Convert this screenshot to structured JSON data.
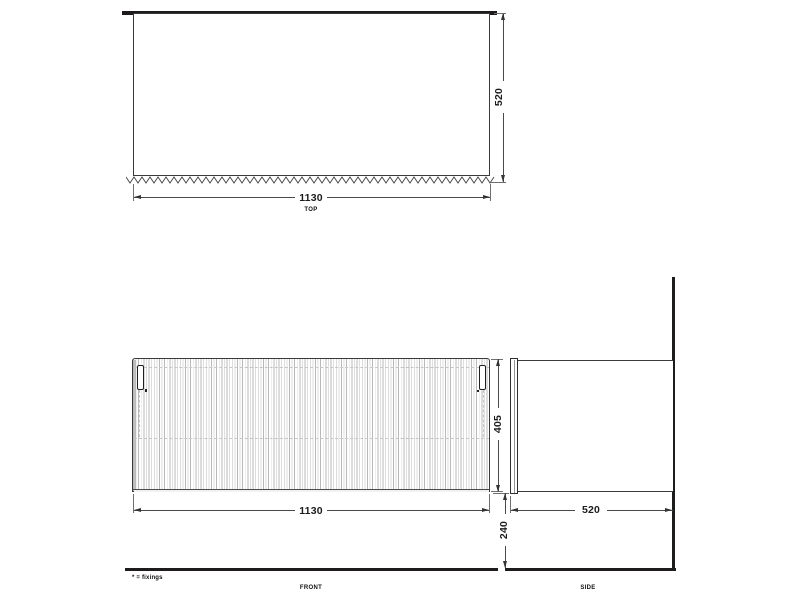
{
  "drawing": {
    "footnote": "* = fixings",
    "views": {
      "top": {
        "label": "TOP",
        "dim_width": "1130",
        "dim_depth": "520"
      },
      "front": {
        "label": "FRONT",
        "dim_width": "1130",
        "dim_height": "405"
      },
      "side": {
        "label": "SIDE",
        "dim_depth": "520",
        "dim_floor_clearance": "240"
      }
    },
    "legend": {
      "asterisk_meaning": "fixings"
    },
    "colors": {
      "line": "#3a3a3a",
      "thick_line": "#1d1b1c",
      "flute_light": "#dedede",
      "flute_dark": "#b9b9b9",
      "hidden_dash": "#c6c6c6",
      "background": "#ffffff"
    }
  }
}
